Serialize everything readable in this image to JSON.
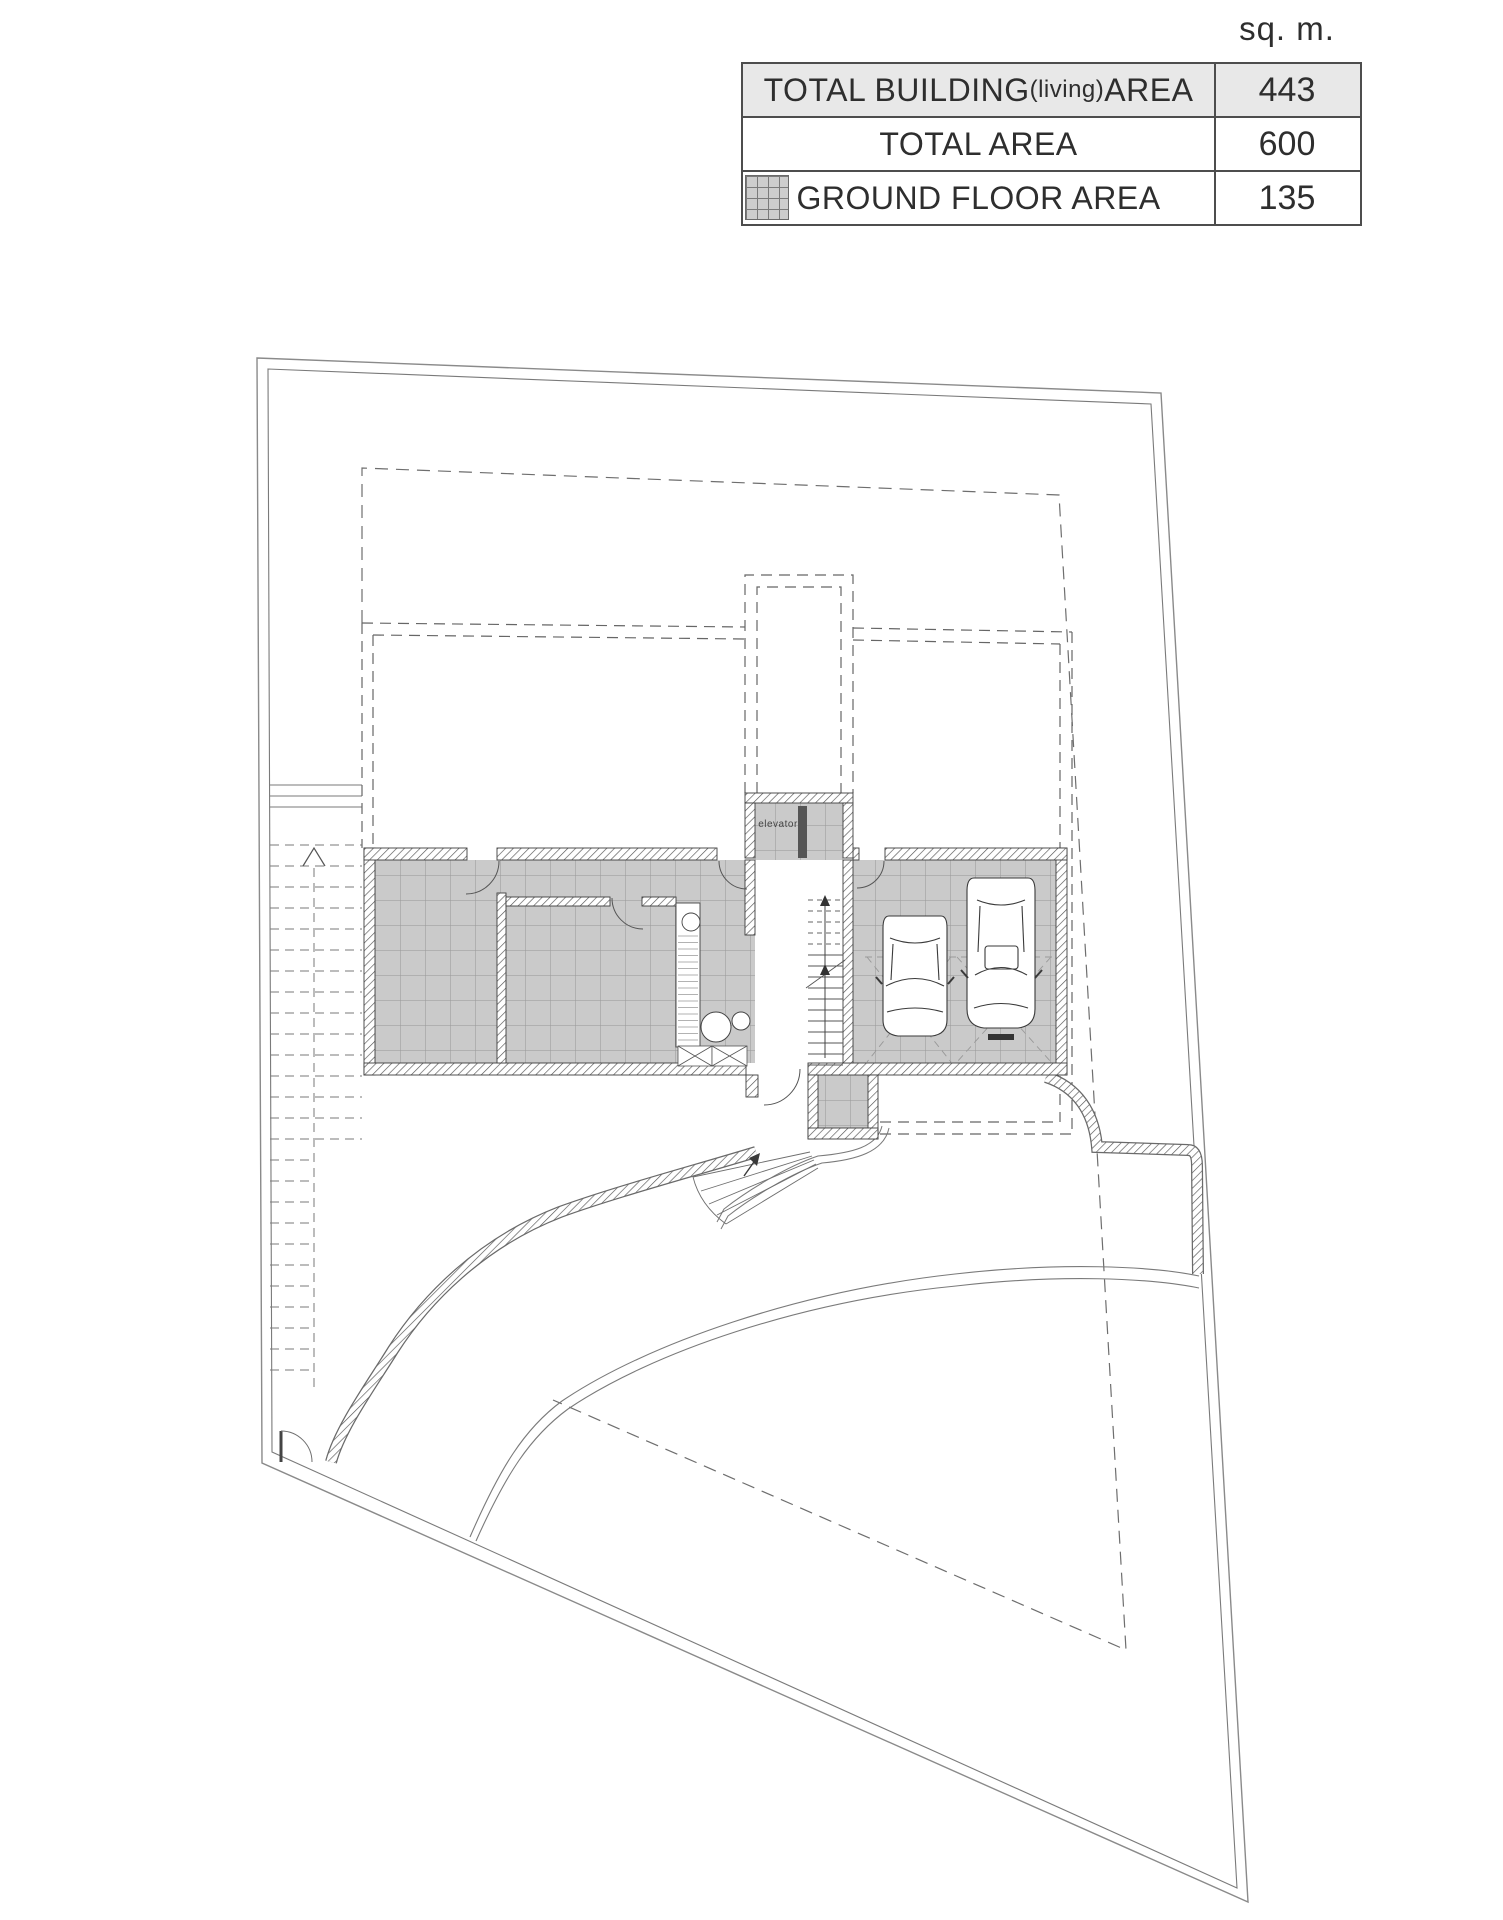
{
  "unit_label": "sq. m.",
  "area_table": {
    "rows": [
      {
        "label_main": "TOTAL BUILDING",
        "label_paren": "(living)",
        "label_tail": " AREA",
        "value": "443"
      },
      {
        "label_main": "TOTAL AREA",
        "label_paren": "",
        "label_tail": "",
        "value": "600"
      },
      {
        "label_main": "GROUND FLOOR AREA",
        "label_paren": "",
        "label_tail": "",
        "value": "135"
      }
    ]
  },
  "plan": {
    "elevator_label": "elevator"
  },
  "colors": {
    "table_header_bg": "#e8e8e8",
    "tile_fill": "#cacaca",
    "tile_grid": "#979797",
    "wall_hatch_line": "#555555",
    "line_dark": "#3a3a3a",
    "line_mid": "#6e6e6e",
    "boundary": "#8a8a8a"
  }
}
